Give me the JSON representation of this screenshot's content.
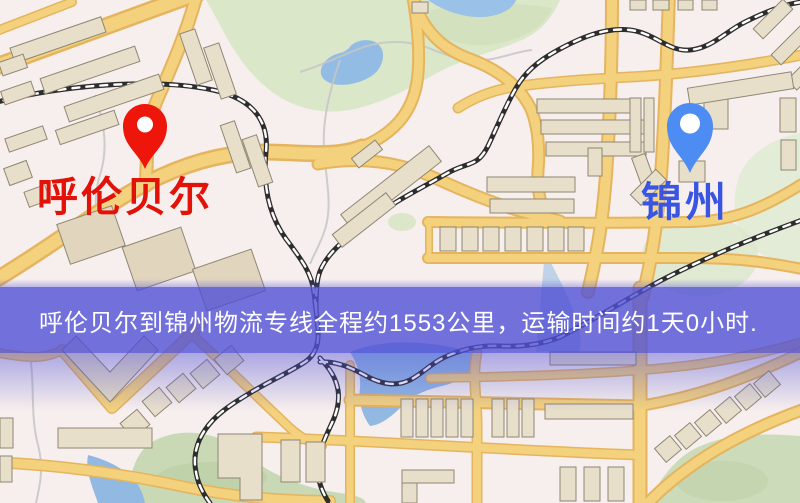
{
  "map": {
    "type": "road-map",
    "theme": {
      "base": "#f7efed",
      "road_fill": "#f4d17d",
      "road_casing": "#e5b45f",
      "park": "#dbe7c9",
      "water": "#93bce4",
      "building": "#e8dfcb",
      "railway": "#2d2d2d"
    }
  },
  "markers": {
    "origin": {
      "label": "呼伦贝尔",
      "pin_color": "#ee150a",
      "label_color": "#e21209"
    },
    "destination": {
      "label": "锦州",
      "pin_color": "#4d8cf2",
      "label_color": "#3a55e2"
    }
  },
  "banner": {
    "text": "呼伦贝尔到锦州物流专线全程约1553公里，运输时间约1天0小时.",
    "background_color": "#5050d6",
    "text_color": "#ffffff",
    "distance_km": "1553",
    "duration": "1天0小时"
  }
}
